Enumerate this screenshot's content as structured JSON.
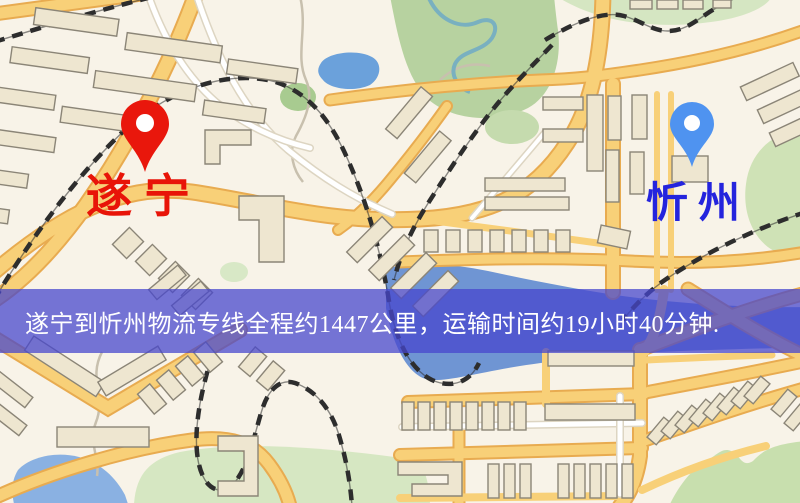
{
  "banner": {
    "text": "遂宁到忻州物流专线全程约1447公里，运输时间约19小时40分钟.",
    "background_color": "rgba(70,70,205,0.74)",
    "text_color": "#ffffff"
  },
  "markers": {
    "origin": {
      "name": "遂宁",
      "pin_icon": "red-pin-icon",
      "pin_color": "#e9170c",
      "label_color": "#e81408"
    },
    "destination": {
      "name": "忻州",
      "pin_icon": "blue-pin-icon",
      "pin_color": "#4f93f0",
      "label_color": "#2424dd"
    }
  },
  "route": {
    "origin": "遂宁",
    "destination": "忻州",
    "distance_text": "1447公里",
    "duration_text": "19小时40分钟"
  },
  "map_colors": {
    "background": "#f8f3e8",
    "road": "#f8d078",
    "road_casing": "#e8ab50",
    "railway": "#2d2d2d",
    "water": "#6f95d3",
    "park": "#cfe2b6",
    "building_fill": "#eee6d0",
    "building_stroke": "#8b8577"
  }
}
